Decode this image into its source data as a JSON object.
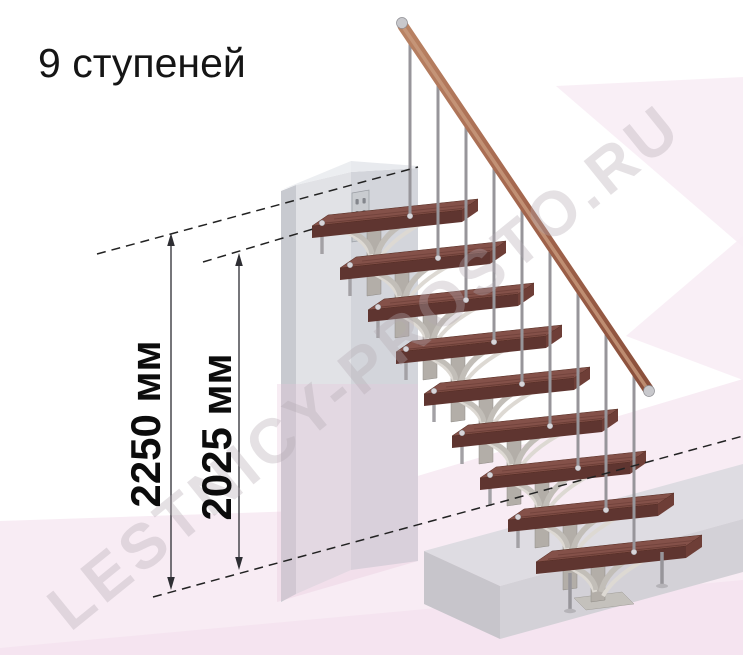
{
  "title": "9 ступеней",
  "watermark_text": "LESTNICY-PROSTO.RU",
  "dimension_labels": {
    "floor_to_floor_height": "2250 мм",
    "floor_to_top_step_height": "2025 мм"
  },
  "staircase": {
    "steps_count": 9,
    "colors": {
      "tread_top": "#845149",
      "tread_front": "#5f3530",
      "tread_side": "#6e3e37",
      "tread_grain": "#4a241e",
      "handrail_dark": "#8a4f3b",
      "handrail_mid": "#a5684f",
      "handrail_light": "#c99b7e",
      "handrail_cap": "#c8c8cc",
      "metal_post": "#97959a",
      "metal_joint": "#d8d5d9",
      "stringer": "#b3aea8",
      "stringer_branch": "#c2beb8",
      "stringer_branch_light": "#ddd9d3",
      "wall_side": "#c8cad0",
      "wall_front_left": "#e1e2e6",
      "wall_front_right": "#d3d5db",
      "wall_top": "#eceef1",
      "wall_plate": "#c9ccd0",
      "platform_top": "#dedce2",
      "platform_front": "#d3d1d7",
      "platform_side": "#c7c5cb",
      "background_accent": "#f8ecf4",
      "background_accent_deep": "#f3dfec",
      "dimension_line": "#3c3c42",
      "dashed_line": "#222222",
      "watermark": "#b4aab2"
    }
  }
}
